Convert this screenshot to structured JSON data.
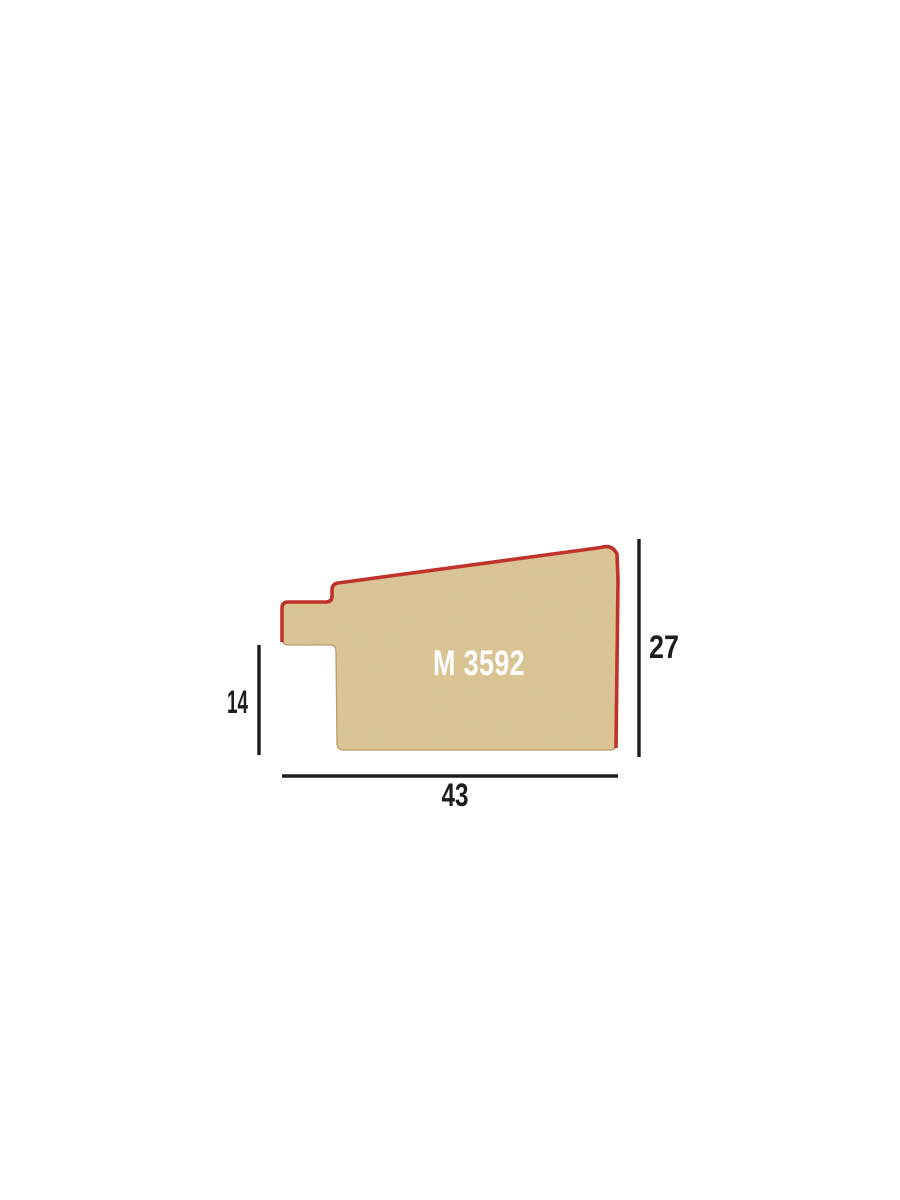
{
  "profile": {
    "code": "M 3592",
    "width": "43",
    "height": "27",
    "rebate": "14"
  },
  "colors": {
    "background": "#ffffff",
    "face_line_red": "#c0332b",
    "wood_fill": "#ddc795",
    "wood_speckle": "#8b6d3f",
    "wood_edge": "#b59a67",
    "dimension_line": "#1d1d1b",
    "dimension_text": "#1d1d1b",
    "code_text": "#ffffff"
  }
}
